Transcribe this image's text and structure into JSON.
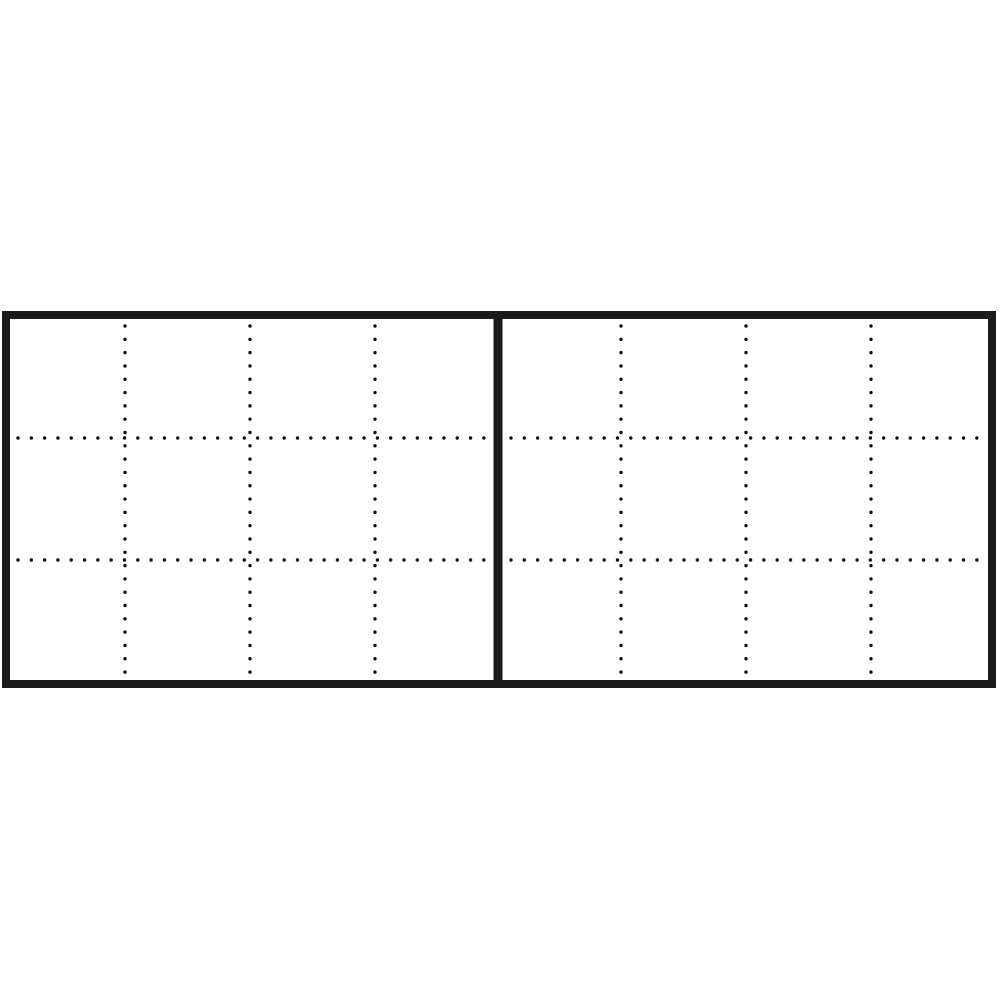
{
  "diagram": {
    "description": "two-panel dotted grid schematic",
    "canvas": {
      "width": 1000,
      "height": 1000,
      "background": "#ffffff"
    },
    "frame": {
      "outer_x": 2,
      "outer_y": 311,
      "outer_width": 994,
      "outer_height": 377,
      "border_width": 8,
      "border_color": "#1b1b1b",
      "fill": "#ffffff"
    },
    "divider": {
      "center_x": 498,
      "width": 9,
      "top_y": 311,
      "bottom_y": 688,
      "color": "#1b1b1b"
    },
    "dotted_line_style": {
      "dot_color": "#111111",
      "dot_diameter": 3.4,
      "dot_spacing": 13.3
    },
    "panels": [
      {
        "id": "left-panel",
        "columns": 4,
        "rows": 3,
        "inner": {
          "x": 10,
          "y": 319,
          "width": 483,
          "height": 361
        },
        "vertical_line_x": [
          125,
          250,
          375
        ],
        "horizontal_line_y": [
          438,
          560
        ]
      },
      {
        "id": "right-panel",
        "columns": 4,
        "rows": 3,
        "inner": {
          "x": 503,
          "y": 319,
          "width": 485,
          "height": 361
        },
        "vertical_line_x": [
          621,
          746,
          871
        ],
        "horizontal_line_y": [
          438,
          560
        ]
      }
    ]
  }
}
